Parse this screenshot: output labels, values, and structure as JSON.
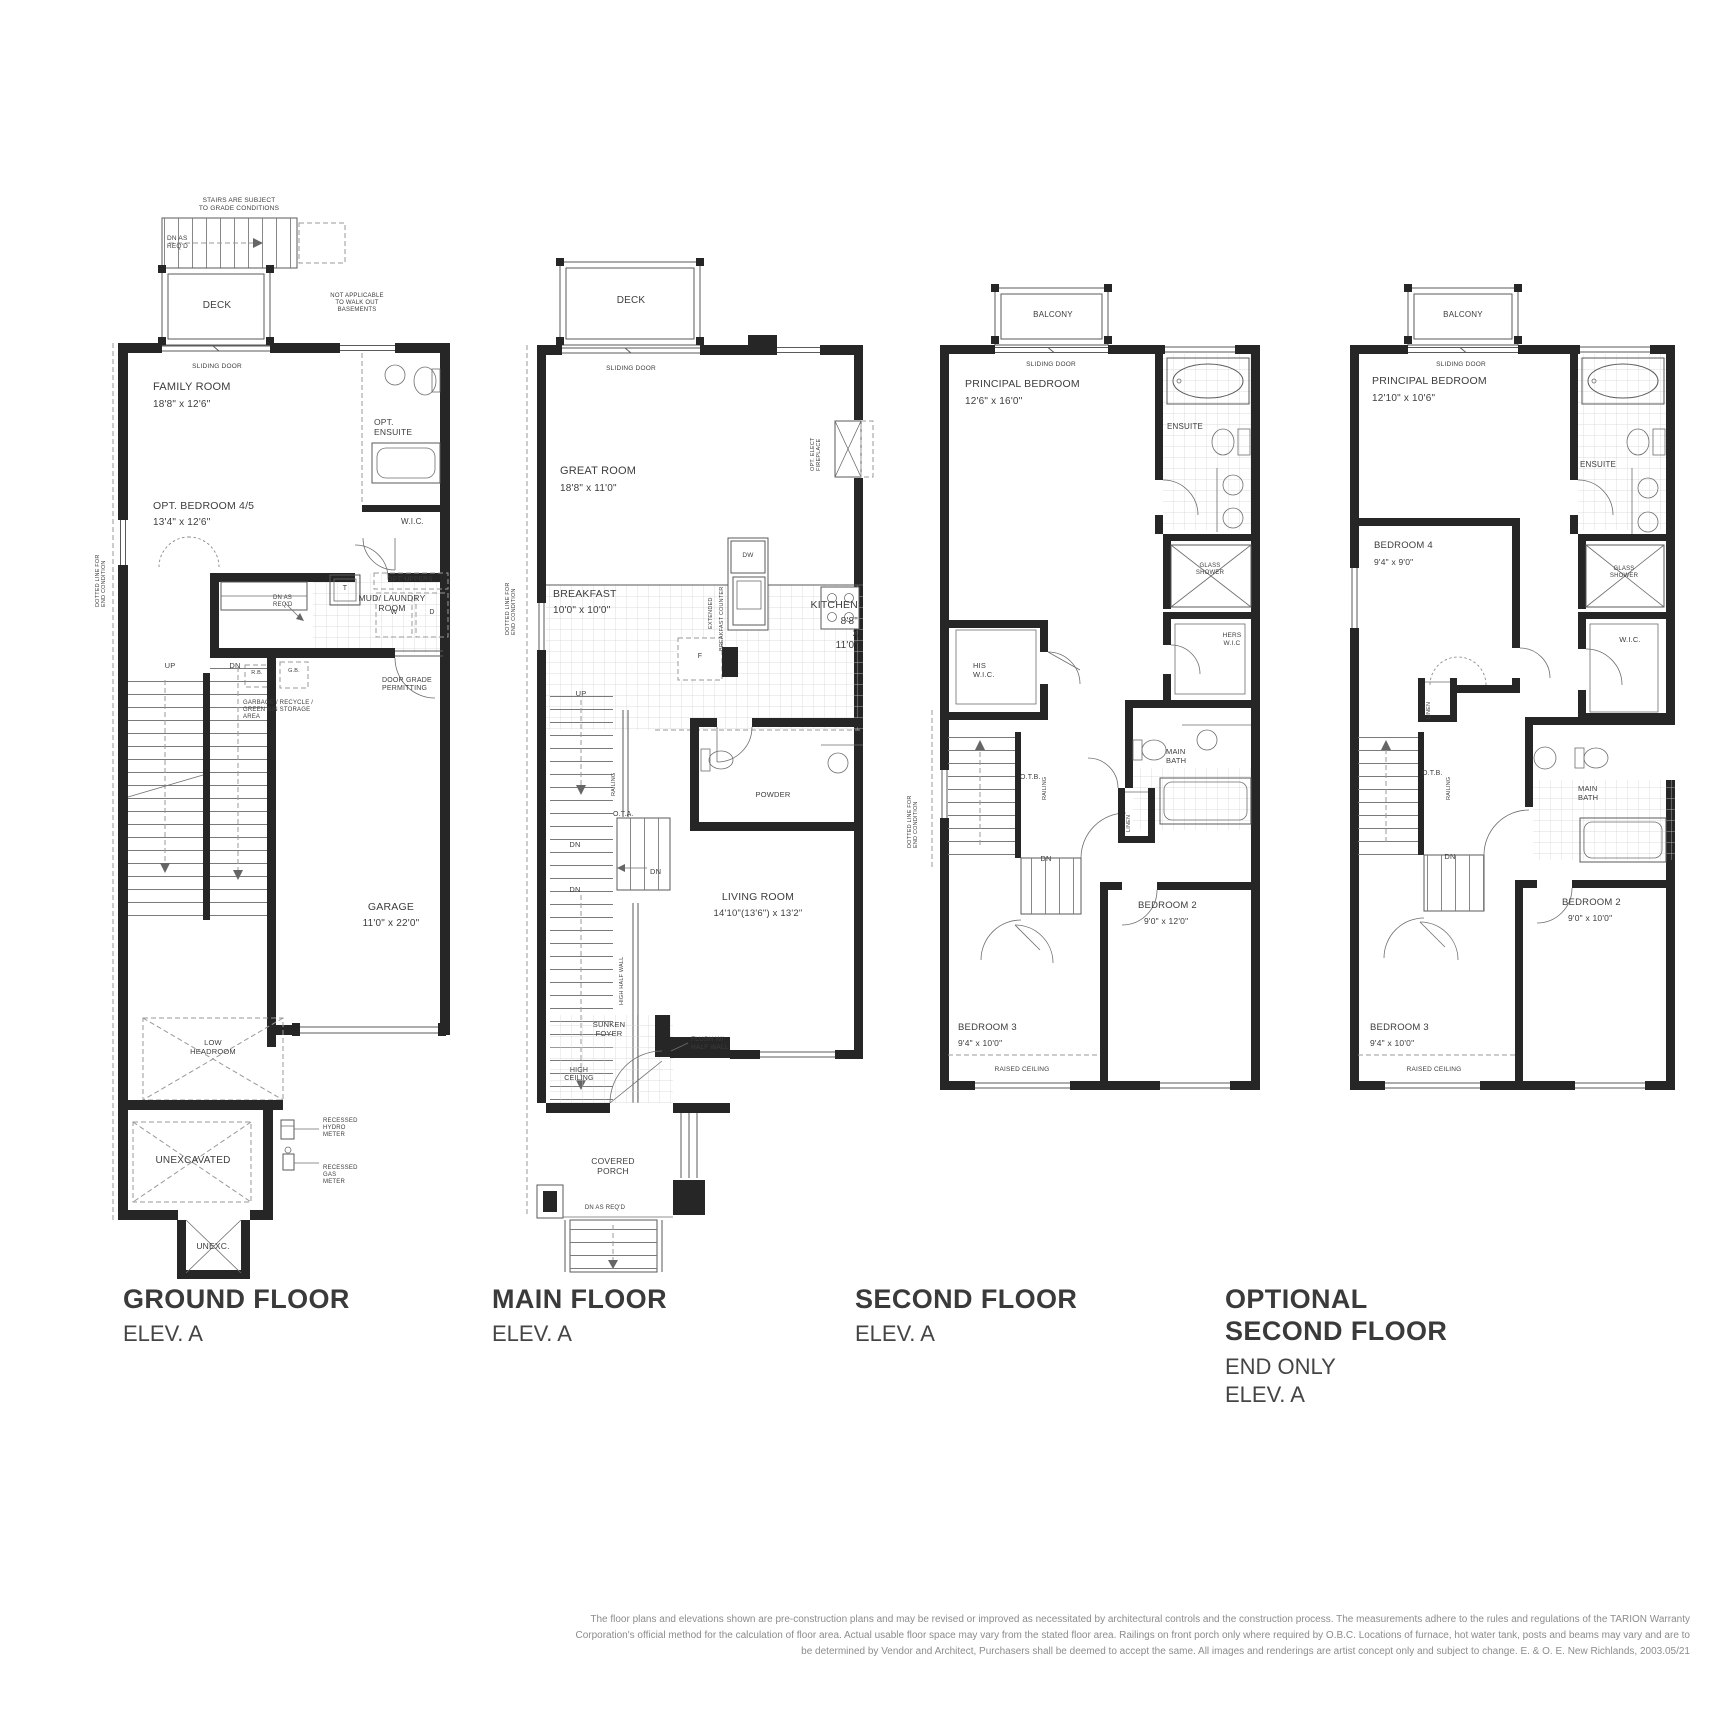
{
  "document": {
    "type": "floor-plan-sheet",
    "sheet_background": "#ffffff"
  },
  "colors": {
    "wall": "#262626",
    "line": "#5a5a5a",
    "text": "#3d3d3d",
    "muted": "#8c8c8c"
  },
  "footer": {
    "line1": "The floor plans and elevations shown are pre-construction plans and may be revised or improved as necessitated by architectural controls and the construction process. The measurements adhere to the rules and regulations of the TARION Warranty",
    "line2": "Corporation's official method for the calculation of floor area. Actual usable floor space may vary from the stated floor area. Railings on front porch only where required by O.B.C. Locations of furnace, hot water tank, posts and beams may vary and are to",
    "line3": "be determined by Vendor and Architect, Purchasers shall be deemed to accept the same. All images and renderings are artist concept only and subject to change. E. & O. E. New Richlands, 2003.05/21"
  },
  "plans": [
    {
      "id": "ground-floor",
      "title": "GROUND FLOOR",
      "subtitle": "ELEV. A",
      "labels": [
        {
          "t": "STAIRS ARE SUBJECT\nTO GRADE CONDITIONS",
          "n": "note-stairs-grade",
          "x": 144,
          "y": 22,
          "fs": 6.5,
          "align": "center"
        },
        {
          "t": "DN AS\nREQ'D",
          "n": "note-dn-as-reqd",
          "x": 72,
          "y": 60,
          "fs": 6.5
        },
        {
          "t": "DECK",
          "n": "room-label-deck",
          "x": 122,
          "y": 125,
          "fs": 10,
          "align": "center"
        },
        {
          "t": "NOT APPLICABLE\nTO WALK OUT\nBASEMENTS",
          "n": "note-walkout",
          "x": 262,
          "y": 118,
          "fs": 6,
          "align": "center"
        },
        {
          "t": "SLIDING DOOR",
          "n": "note-sliding-door",
          "x": 122,
          "y": 188,
          "fs": 6.5,
          "align": "center"
        },
        {
          "t": "FAMILY ROOM",
          "n": "room-label-family-room",
          "x": 58,
          "y": 206,
          "fs": 11
        },
        {
          "t": "18'8\" x 12'6\"",
          "n": "dims-family-room",
          "x": 58,
          "y": 224,
          "fs": 10
        },
        {
          "t": "OPT.\nENSUITE",
          "n": "room-label-opt-ensuite",
          "x": 279,
          "y": 242,
          "fs": 8.5
        },
        {
          "t": "OPT. BEDROOM 4/5",
          "n": "room-label-opt-bedroom",
          "x": 58,
          "y": 325,
          "fs": 10.5
        },
        {
          "t": "13'4\" x 12'6\"",
          "n": "dims-opt-bedroom",
          "x": 58,
          "y": 342,
          "fs": 10
        },
        {
          "t": "W.I.C.",
          "n": "room-label-wic",
          "x": 306,
          "y": 342,
          "fs": 8
        },
        {
          "t": "DOTTED LINE FOR\nEND CONDITION",
          "n": "note-end-condition",
          "x": 0,
          "y": 432,
          "fs": 5.5,
          "rot": -90
        },
        {
          "t": "OPT. UPPERS",
          "n": "note-opt-uppers",
          "x": 315,
          "y": 401,
          "fs": 6.5,
          "align": "center"
        },
        {
          "t": "T",
          "n": "fixture-label-tub",
          "x": 250,
          "y": 410,
          "fs": 7,
          "align": "center"
        },
        {
          "t": "W",
          "n": "fixture-label-washer",
          "x": 299,
          "y": 434,
          "fs": 7,
          "align": "center"
        },
        {
          "t": "D",
          "n": "fixture-label-dryer",
          "x": 337,
          "y": 434,
          "fs": 7,
          "align": "center"
        },
        {
          "t": "MUD/ LAUNDRY\nROOM",
          "n": "room-label-mud-laundry",
          "x": 297,
          "y": 418,
          "fs": 8.5,
          "align": "center"
        },
        {
          "t": "DN AS\nREQ'D",
          "n": "note-dn-as-reqd-2",
          "x": 178,
          "y": 420,
          "fs": 6
        },
        {
          "t": "UP",
          "n": "note-up",
          "x": 75,
          "y": 487,
          "fs": 7.5,
          "align": "center"
        },
        {
          "t": "DN",
          "n": "note-dn",
          "x": 140,
          "y": 487,
          "fs": 7.5,
          "align": "center"
        },
        {
          "t": "R.B.",
          "n": "fixture-label-rb",
          "x": 162,
          "y": 495,
          "fs": 5.5,
          "align": "center"
        },
        {
          "t": "G.B.",
          "n": "fixture-label-gb",
          "x": 199,
          "y": 493,
          "fs": 5.5,
          "align": "center"
        },
        {
          "t": "DOOR GRADE\nPERMITTING",
          "n": "note-door-grade",
          "x": 287,
          "y": 502,
          "fs": 7
        },
        {
          "t": "GARBAGE / RECYCLE /\nGREEN BIN STORAGE\nAREA",
          "n": "note-garbage-storage",
          "x": 148,
          "y": 525,
          "fs": 6
        },
        {
          "t": "GARAGE",
          "n": "room-label-garage",
          "x": 296,
          "y": 726,
          "fs": 10.5,
          "align": "center"
        },
        {
          "t": "11'0\" x 22'0\"",
          "n": "dims-garage",
          "x": 296,
          "y": 743,
          "fs": 10,
          "align": "center"
        },
        {
          "t": "LOW\nHEADROOM",
          "n": "note-low-headroom",
          "x": 118,
          "y": 864,
          "fs": 7.5,
          "align": "center"
        },
        {
          "t": "UNEXCAVATED",
          "n": "room-label-unexcavated",
          "x": 98,
          "y": 980,
          "fs": 10,
          "align": "center"
        },
        {
          "t": "RECESSED\nHYDRO\nMETER",
          "n": "note-hydro-meter",
          "x": 228,
          "y": 943,
          "fs": 6
        },
        {
          "t": "RECESSED\nGAS\nMETER",
          "n": "note-gas-meter",
          "x": 228,
          "y": 990,
          "fs": 6
        },
        {
          "t": "UNEXC.",
          "n": "room-label-unexc",
          "x": 118,
          "y": 1066,
          "fs": 8.5,
          "align": "center"
        }
      ]
    },
    {
      "id": "main-floor",
      "title": "MAIN FLOOR",
      "subtitle": "ELEV. A",
      "labels": [
        {
          "t": "DECK",
          "n": "room-label-deck",
          "x": 126,
          "y": 40,
          "fs": 10,
          "align": "center"
        },
        {
          "t": "SLIDING DOOR",
          "n": "note-sliding-door",
          "x": 126,
          "y": 110,
          "fs": 6.5,
          "align": "center"
        },
        {
          "t": "GREAT ROOM",
          "n": "room-label-great-room",
          "x": 55,
          "y": 210,
          "fs": 11
        },
        {
          "t": "18'8\" x 11'0\"",
          "n": "dims-great-room",
          "x": 55,
          "y": 228,
          "fs": 10
        },
        {
          "t": "OPT. ELECT\nFIREPLACE",
          "n": "note-fireplace",
          "x": 305,
          "y": 216,
          "fs": 5.5,
          "rot": -90
        },
        {
          "t": "BREAKFAST",
          "n": "room-label-breakfast",
          "x": 48,
          "y": 333,
          "fs": 10.5
        },
        {
          "t": "10'0\" x 10'0\"",
          "n": "dims-breakfast",
          "x": 48,
          "y": 350,
          "fs": 10
        },
        {
          "t": "EXTENDED",
          "n": "note-extended",
          "x": 203,
          "y": 374,
          "fs": 5.5,
          "rot": -90
        },
        {
          "t": "BREAKFAST COUNTER",
          "n": "note-breakfast-counter",
          "x": 214,
          "y": 396,
          "fs": 5.5,
          "rot": -90
        },
        {
          "t": "DW",
          "n": "fixture-label-dw",
          "x": 243,
          "y": 297,
          "fs": 6.5,
          "align": "center"
        },
        {
          "t": "KITCHEN",
          "n": "room-label-kitchen",
          "x": 353,
          "y": 344,
          "fs": 10.5,
          "align": "right"
        },
        {
          "t": "8'8\" x 11'0\"",
          "n": "dims-kitchen",
          "x": 353,
          "y": 361,
          "fs": 10,
          "align": "right"
        },
        {
          "t": "F",
          "n": "fixture-label-fridge",
          "x": 195,
          "y": 398,
          "fs": 7,
          "align": "center"
        },
        {
          "t": "UP",
          "n": "note-up",
          "x": 76,
          "y": 435,
          "fs": 7.5,
          "align": "center"
        },
        {
          "t": "RAILING",
          "n": "note-railing",
          "x": 106,
          "y": 541,
          "fs": 5.5,
          "rot": -90
        },
        {
          "t": "O.T.A.",
          "n": "note-ota",
          "x": 108,
          "y": 556,
          "fs": 7
        },
        {
          "t": "DN",
          "n": "note-dn-1",
          "x": 70,
          "y": 586,
          "fs": 7.5,
          "align": "center"
        },
        {
          "t": "DN",
          "n": "note-dn-2",
          "x": 145,
          "y": 613,
          "fs": 7.5
        },
        {
          "t": "DN",
          "n": "note-dn-3",
          "x": 70,
          "y": 631,
          "fs": 7.5,
          "align": "center"
        },
        {
          "t": "HIGH HALF WALL",
          "n": "note-high-half-wall",
          "x": 114,
          "y": 750,
          "fs": 5.5,
          "rot": -90
        },
        {
          "t": "POWDER",
          "n": "room-label-powder",
          "x": 268,
          "y": 536,
          "fs": 7.5,
          "align": "center"
        },
        {
          "t": "LIVING ROOM",
          "n": "room-label-living-room",
          "x": 253,
          "y": 636,
          "fs": 10.5,
          "align": "center"
        },
        {
          "t": "14'10\"(13'6\") x 13'2\"",
          "n": "dims-living-room",
          "x": 253,
          "y": 653,
          "fs": 9.5,
          "align": "center"
        },
        {
          "t": "FLUSH W/\nHALF WALL",
          "n": "note-flush-half-wall",
          "x": 186,
          "y": 781,
          "fs": 6.5
        },
        {
          "t": "SUNKEN\nFOYER",
          "n": "room-label-sunken-foyer",
          "x": 104,
          "y": 766,
          "fs": 7.5,
          "align": "center"
        },
        {
          "t": "HIGH\nCEILING",
          "n": "note-high-ceiling",
          "x": 74,
          "y": 812,
          "fs": 7,
          "align": "center"
        },
        {
          "t": "COVERED\nPORCH",
          "n": "room-label-covered-porch",
          "x": 108,
          "y": 901,
          "fs": 8.5,
          "align": "center"
        },
        {
          "t": "DN AS REQ'D",
          "n": "note-dn-as-reqd",
          "x": 100,
          "y": 950,
          "fs": 6,
          "align": "center"
        },
        {
          "t": "DOTTED LINE FOR\nEND CONDITION",
          "n": "note-end-condition",
          "x": 0,
          "y": 380,
          "fs": 5.5,
          "rot": -90
        }
      ]
    },
    {
      "id": "second-floor",
      "title": "SECOND FLOOR",
      "subtitle": "ELEV. A",
      "labels": [
        {
          "t": "BALCONY",
          "n": "room-label-balcony",
          "x": 133,
          "y": 40,
          "fs": 8,
          "align": "center"
        },
        {
          "t": "SLIDING DOOR",
          "n": "note-sliding-door",
          "x": 131,
          "y": 91,
          "fs": 6.5,
          "align": "center"
        },
        {
          "t": "PRINCIPAL BEDROOM",
          "n": "room-label-principal-bedroom",
          "x": 45,
          "y": 108,
          "fs": 10.5
        },
        {
          "t": "12'6\" x 16'0\"",
          "n": "dims-principal-bedroom",
          "x": 45,
          "y": 126,
          "fs": 10
        },
        {
          "t": "ENSUITE",
          "n": "room-label-ensuite",
          "x": 247,
          "y": 152,
          "fs": 8
        },
        {
          "t": "GLASS\nSHOWER",
          "n": "fixture-label-glass-shower",
          "x": 290,
          "y": 293,
          "fs": 6,
          "align": "center"
        },
        {
          "t": "HERS\nW.I.C",
          "n": "room-label-hers-wic",
          "x": 312,
          "y": 362,
          "fs": 6.5,
          "align": "center"
        },
        {
          "t": "HIS\nW.I.C.",
          "n": "room-label-his-wic",
          "x": 53,
          "y": 392,
          "fs": 7.5
        },
        {
          "t": "O.T.B.",
          "n": "note-otb",
          "x": 100,
          "y": 504,
          "fs": 7
        },
        {
          "t": "RAILING",
          "n": "note-railing",
          "x": 122,
          "y": 530,
          "fs": 5.5,
          "rot": -90
        },
        {
          "t": "DOTTED LINE FOR\nEND CONDITION",
          "n": "note-end-condition",
          "x": -13,
          "y": 578,
          "fs": 5.5,
          "rot": -90
        },
        {
          "t": "MAIN\nBATH",
          "n": "room-label-main-bath",
          "x": 246,
          "y": 478,
          "fs": 7.5
        },
        {
          "t": "LINEN",
          "n": "room-label-linen",
          "x": 206,
          "y": 562,
          "fs": 5.5,
          "rot": -90
        },
        {
          "t": "DN",
          "n": "note-dn",
          "x": 126,
          "y": 585,
          "fs": 7.5,
          "align": "center"
        },
        {
          "t": "BEDROOM 3",
          "n": "room-label-bedroom-3",
          "x": 38,
          "y": 752,
          "fs": 9.5
        },
        {
          "t": "9'4\" x 10'0\"",
          "n": "dims-bedroom-3",
          "x": 38,
          "y": 768,
          "fs": 8.5
        },
        {
          "t": "RAISED CEILING",
          "n": "note-raised-ceiling",
          "x": 102,
          "y": 796,
          "fs": 6.5,
          "align": "center"
        },
        {
          "t": "BEDROOM 2",
          "n": "room-label-bedroom-2",
          "x": 218,
          "y": 630,
          "fs": 9.5
        },
        {
          "t": "9'0\" x 12'0\"",
          "n": "dims-bedroom-2",
          "x": 224,
          "y": 646,
          "fs": 8.5
        }
      ]
    },
    {
      "id": "optional-second-floor",
      "title": "OPTIONAL\nSECOND FLOOR",
      "subtitle": "END ONLY\nELEV. A",
      "labels": [
        {
          "t": "BALCONY",
          "n": "room-label-balcony",
          "x": 133,
          "y": 40,
          "fs": 8,
          "align": "center"
        },
        {
          "t": "SLIDING DOOR",
          "n": "note-sliding-door",
          "x": 131,
          "y": 91,
          "fs": 6.5,
          "align": "center"
        },
        {
          "t": "PRINCIPAL BEDROOM",
          "n": "room-label-principal-bedroom",
          "x": 42,
          "y": 105,
          "fs": 10.5
        },
        {
          "t": "12'10\" x 10'6\"",
          "n": "dims-principal-bedroom",
          "x": 42,
          "y": 123,
          "fs": 10
        },
        {
          "t": "ENSUITE",
          "n": "room-label-ensuite",
          "x": 250,
          "y": 190,
          "fs": 8
        },
        {
          "t": "BEDROOM 4",
          "n": "room-label-bedroom-4",
          "x": 44,
          "y": 270,
          "fs": 9.5
        },
        {
          "t": "9'4\" x 9'0\"",
          "n": "dims-bedroom-4",
          "x": 44,
          "y": 287,
          "fs": 8.5
        },
        {
          "t": "GLASS\nSHOWER",
          "n": "fixture-label-glass-shower",
          "x": 294,
          "y": 296,
          "fs": 6,
          "align": "center"
        },
        {
          "t": "W.I.C.",
          "n": "room-label-wic",
          "x": 300,
          "y": 366,
          "fs": 7.5,
          "align": "center"
        },
        {
          "t": "LINEN",
          "n": "room-label-linen",
          "x": 96,
          "y": 449,
          "fs": 5.5,
          "rot": -90
        },
        {
          "t": "O.T.B.",
          "n": "note-otb",
          "x": 92,
          "y": 500,
          "fs": 7
        },
        {
          "t": "RAILING",
          "n": "note-railing",
          "x": 116,
          "y": 530,
          "fs": 5.5,
          "rot": -90
        },
        {
          "t": "DN",
          "n": "note-dn",
          "x": 120,
          "y": 583,
          "fs": 7.5,
          "align": "center"
        },
        {
          "t": "MAIN\nBATH",
          "n": "room-label-main-bath",
          "x": 248,
          "y": 515,
          "fs": 7.5
        },
        {
          "t": "BEDROOM 3",
          "n": "room-label-bedroom-3",
          "x": 40,
          "y": 752,
          "fs": 9.5
        },
        {
          "t": "9'4\" x 10'0\"",
          "n": "dims-bedroom-3",
          "x": 40,
          "y": 768,
          "fs": 8.5
        },
        {
          "t": "RAISED CEILING",
          "n": "note-raised-ceiling",
          "x": 104,
          "y": 796,
          "fs": 6.5,
          "align": "center"
        },
        {
          "t": "BEDROOM 2",
          "n": "room-label-bedroom-2",
          "x": 232,
          "y": 627,
          "fs": 9.5
        },
        {
          "t": "9'0\" x 10'0\"",
          "n": "dims-bedroom-2",
          "x": 238,
          "y": 643,
          "fs": 8.5
        }
      ]
    }
  ]
}
